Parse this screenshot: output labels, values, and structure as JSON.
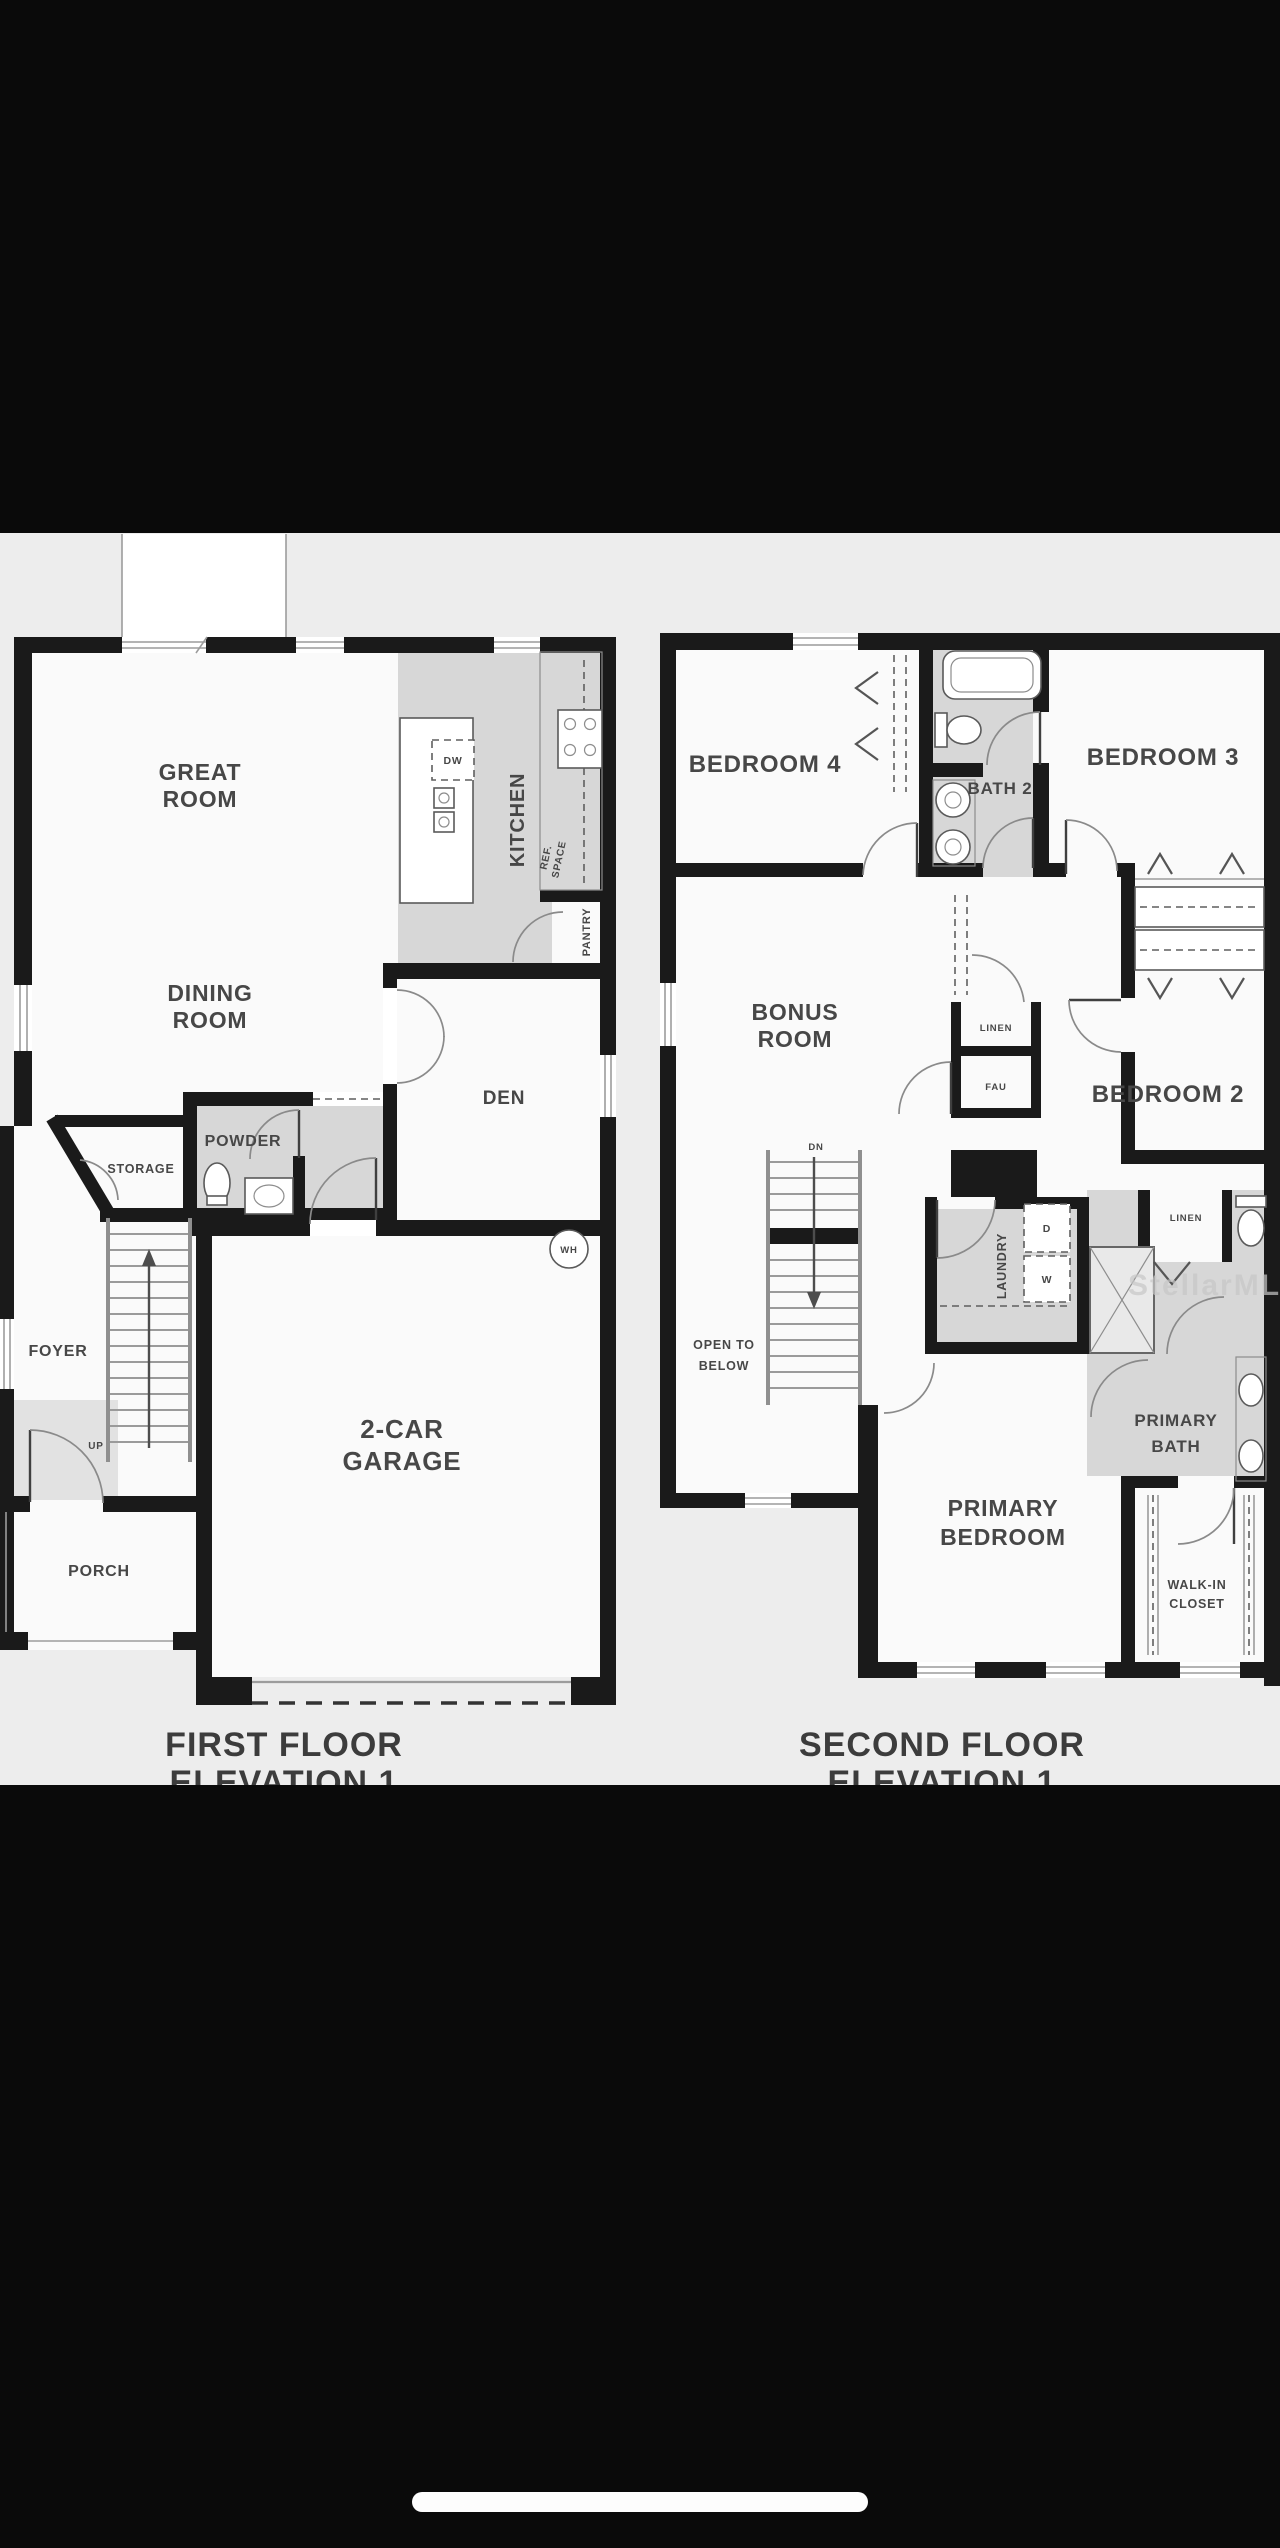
{
  "image": {
    "watermark": "StellarMLS"
  },
  "first_floor": {
    "title_line1": "FIRST FLOOR",
    "title_line2": "ELEVATION 1",
    "labels": {
      "great_1": "GREAT",
      "great_2": "ROOM",
      "dining_1": "DINING",
      "dining_2": "ROOM",
      "kitchen": "KITCHEN",
      "dw": "DW",
      "ref_1": "REF.",
      "ref_2": "SPACE",
      "pantry": "PANTRY",
      "den": "DEN",
      "powder": "POWDER",
      "storage": "STORAGE",
      "foyer": "FOYER",
      "up": "UP",
      "wh": "WH",
      "garage_1": "2-CAR",
      "garage_2": "GARAGE",
      "porch": "PORCH"
    }
  },
  "second_floor": {
    "title_line1": "SECOND FLOOR",
    "title_line2": "ELEVATION 1",
    "labels": {
      "bedroom4": "BEDROOM 4",
      "bath2": "BATH 2",
      "bedroom3": "BEDROOM 3",
      "bonus_1": "BONUS",
      "bonus_2": "ROOM",
      "linen_hall": "LINEN",
      "fau": "FAU",
      "bedroom2": "BEDROOM 2",
      "dn": "DN",
      "open_below_1": "OPEN TO",
      "open_below_2": "BELOW",
      "laundry": "LAUNDRY",
      "dryer": "D",
      "washer": "W",
      "linen_bath": "LINEN",
      "primary_bath_1": "PRIMARY",
      "primary_bath_2": "BATH",
      "primary_bedroom_1": "PRIMARY",
      "primary_bedroom_2": "BEDROOM",
      "walk_in_1": "WALK-IN",
      "walk_in_2": "CLOSET"
    }
  }
}
